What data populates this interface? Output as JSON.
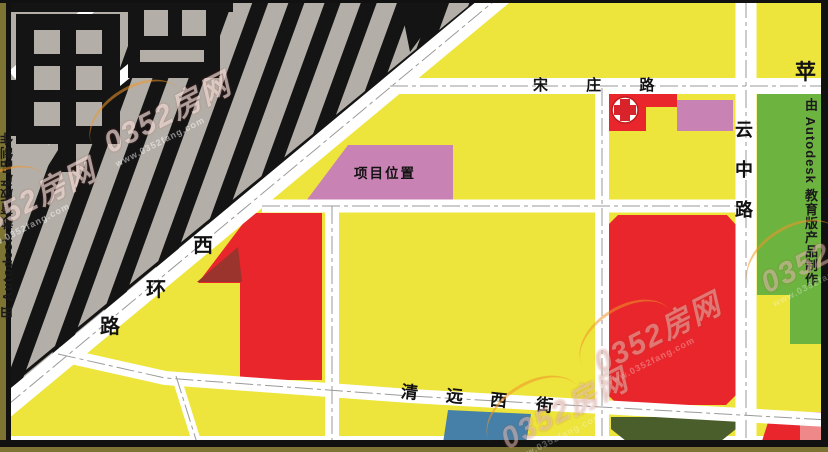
{
  "colors": {
    "yellow": "#EDE43C",
    "gray": "#B3AFA8",
    "building": "#141414",
    "red": "#E8262B",
    "dark_red": "#9C342E",
    "pink": "#C982B4",
    "green": "#6DB340",
    "dark_green": "#4A5E2B",
    "blue": "#4680A8",
    "light_red": "#EF8888",
    "road_white": "#FFFFFF",
    "frame_olive": "#7D7434"
  },
  "roads": {
    "songzhuang": {
      "label": "宋 庄 路"
    },
    "yunzhong": {
      "label": "云中路"
    },
    "xihuan": {
      "chars": [
        "西",
        "环",
        "路"
      ]
    },
    "qingyuan": {
      "chars": [
        "清",
        "远",
        "西",
        "街"
      ]
    },
    "pingguoyuan": {
      "label": "苹"
    }
  },
  "blocks": {
    "project": {
      "label": "项目位置"
    }
  },
  "icons": {
    "hospital": "red-cross-in-circle"
  },
  "stamps": {
    "autodesk": "由 Autodesk 教育版产品制作"
  },
  "watermark": {
    "text": "0352房网",
    "url": "www.0352fang.com"
  }
}
